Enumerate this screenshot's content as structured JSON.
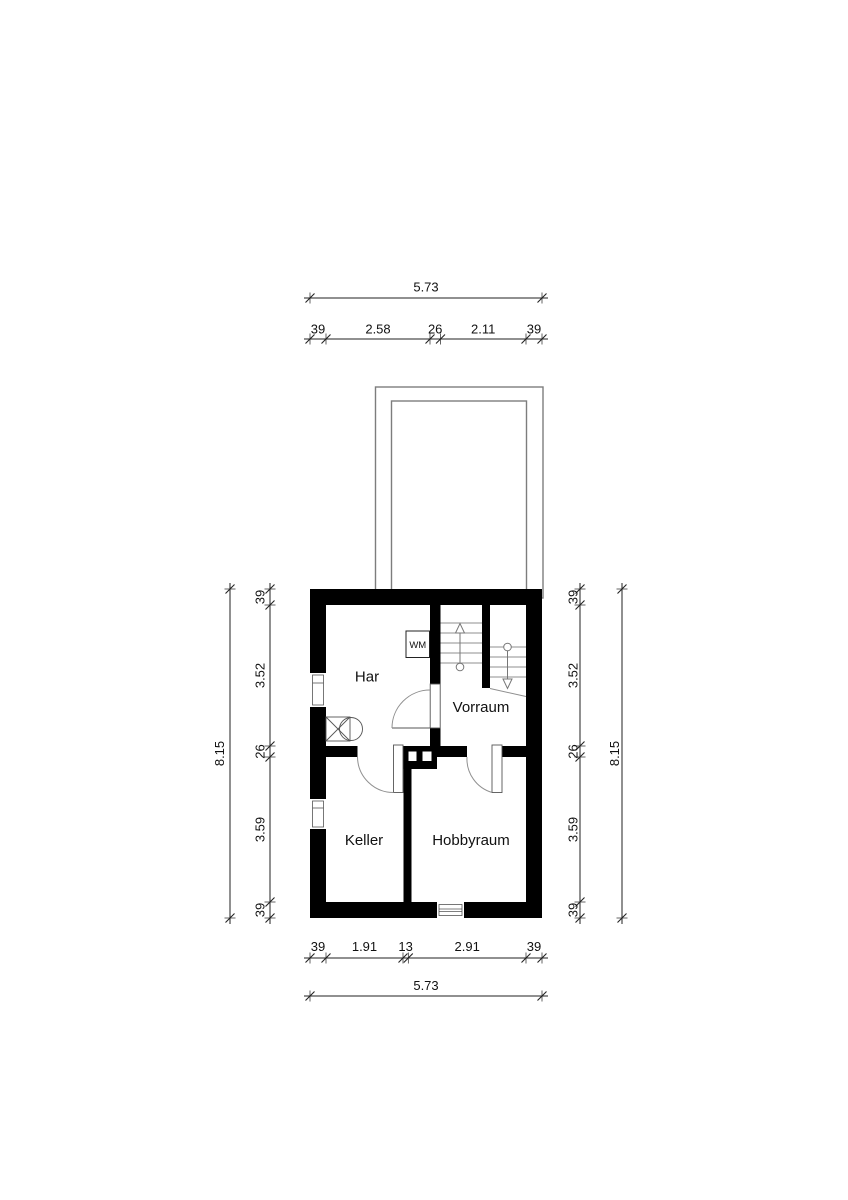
{
  "floorplan": {
    "rooms": {
      "har": "Har",
      "vorraum": "Vorraum",
      "keller": "Keller",
      "hobbyraum": "Hobbyraum"
    },
    "appliances": {
      "washing_machine": "WM"
    },
    "dimensions": {
      "top": {
        "overall": "5.73",
        "segments": [
          "39",
          "2.58",
          "26",
          "2.11",
          "39"
        ]
      },
      "bottom": {
        "overall": "5.73",
        "segments": [
          "39",
          "1.91",
          "13",
          "2.91",
          "39"
        ]
      },
      "left": {
        "overall": "8.15",
        "segments": [
          "39",
          "3.52",
          "26",
          "3.59",
          "39"
        ]
      },
      "right": {
        "overall": "8.15",
        "segments": [
          "39",
          "3.52",
          "26",
          "3.59",
          "39"
        ]
      }
    }
  }
}
